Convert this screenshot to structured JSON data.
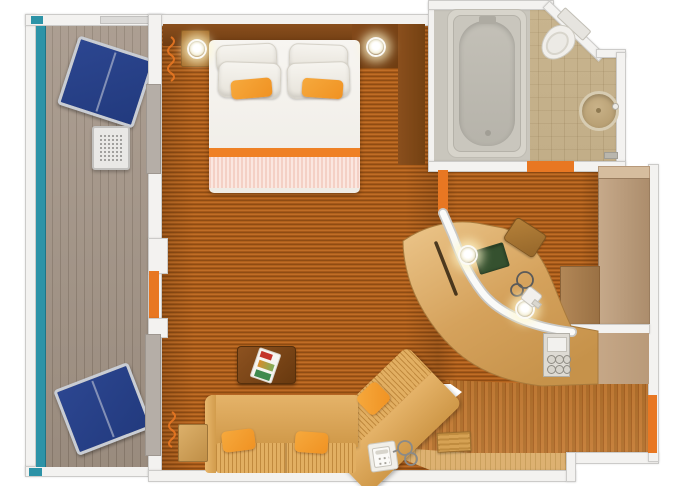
{
  "figure": {
    "kind": "cruise-cabin-floorplan",
    "rooms": [
      {
        "id": "balcony",
        "furniture": [
          "lounge-chair-top",
          "perforated-side-table",
          "lounge-chair-bottom",
          "glass-railing"
        ]
      },
      {
        "id": "bedroom",
        "furniture": [
          "headboard",
          "king-bed",
          "white-pillows",
          "orange-accent-pillows",
          "nightstand-left",
          "corner-cabinet",
          "wall-panel-right",
          "recessed-light",
          "recessed-light",
          "curtain"
        ]
      },
      {
        "id": "bathroom",
        "furniture": [
          "bathtub",
          "toilet",
          "round-sink",
          "door-threshold"
        ]
      },
      {
        "id": "dressing-area",
        "furniture": [
          "curved-vanity-desk",
          "stool",
          "desk-blotter",
          "hair-dryer",
          "recessed-light",
          "recessed-light",
          "minibar-glass-tray",
          "wardrobe",
          "closet-cabinet"
        ]
      },
      {
        "id": "living-area",
        "furniture": [
          "sectional-sofa",
          "throw-pillow",
          "throw-pillow",
          "throw-pillow",
          "coffee-table",
          "magazine",
          "side-table",
          "telephone-with-cord",
          "console-table",
          "curtain"
        ]
      },
      {
        "id": "entry",
        "furniture": [
          "entry-door",
          "floor-step",
          "wooden-step-stool"
        ]
      }
    ],
    "palette": {
      "teal": "#2d93a7",
      "door_orange": "#e87722",
      "pillow_orange": "#f09222",
      "lounger_navy": "#223a7e",
      "carpet_a": "#8f4c13",
      "carpet_b": "#b0611c",
      "wall_fill": "#f3f2f0",
      "wall_border": "#cccbc9",
      "deck_gray": "#a39486",
      "sofa_tan": "#d9a55a",
      "desk_wood": "#d5a25c",
      "dark_table_wood": "#7d4617",
      "bath_tile_tan": "#c5b18b",
      "tub_gray": "#c9c6bd",
      "bed_white": "#f5f3ee",
      "blotter_green": "#35512f"
    }
  }
}
